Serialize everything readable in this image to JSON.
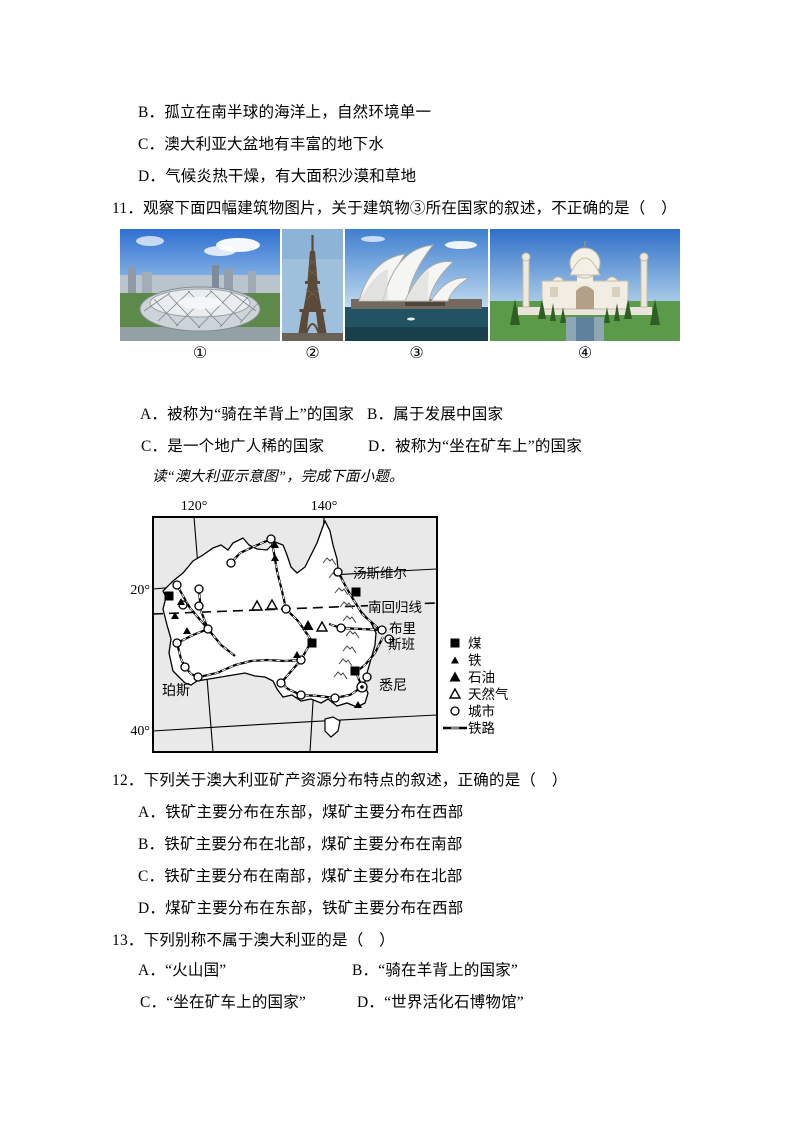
{
  "prev_question_options": [
    "B．孤立在南半球的海洋上，自然环境单一",
    "C．澳大利亚大盆地有丰富的地下水",
    "D．气候炎热干燥，有大面积沙漠和草地"
  ],
  "q11": {
    "stem": "11．观察下面四幅建筑物图片，关于建筑物③所在国家的叙述，不正确的是（　）",
    "image_labels": [
      "①",
      "②",
      "③",
      "④"
    ],
    "image_names": [
      "beijing-national-stadium",
      "eiffel-tower",
      "sydney-opera-house",
      "taj-mahal"
    ],
    "options": [
      "A．被称为“骑在羊背上”的国家",
      "B．属于发展中国家",
      "C．是一个地广人稀的国家",
      "D．被称为“坐在矿车上”的国家"
    ]
  },
  "reading_note": "读“澳大利亚示意图”，完成下面小题。",
  "map": {
    "title": "澳大利亚示意图",
    "lon_labels": [
      "120°",
      "140°"
    ],
    "lat_labels": [
      "20°",
      "40°"
    ],
    "tropic_label": "南回归线",
    "cities": {
      "townsville": "汤斯维尔",
      "brisbane_line1": "布里",
      "brisbane_line2": "斯班",
      "sydney": "悉尼",
      "perth": "珀斯"
    },
    "legend": [
      {
        "symbol": "coal-square",
        "label": "煤"
      },
      {
        "symbol": "iron-triangle-small",
        "label": "铁"
      },
      {
        "symbol": "oil-triangle-large",
        "label": "石油"
      },
      {
        "symbol": "gas-triangle-open",
        "label": "天然气"
      },
      {
        "symbol": "city-circle",
        "label": "城市"
      },
      {
        "symbol": "railway-line",
        "label": "铁路"
      }
    ],
    "colors": {
      "ocean": "#e9e9e9",
      "land": "#ffffff",
      "ink": "#000000"
    }
  },
  "q12": {
    "stem": "12．下列关于澳大利亚矿产资源分布特点的叙述，正确的是（　）",
    "options": [
      "A．铁矿主要分布在东部，煤矿主要分布在西部",
      "B．铁矿主要分布在北部，煤矿主要分布在南部",
      "C．铁矿主要分布在南部，煤矿主要分布在北部",
      "D．煤矿主要分布在东部，铁矿主要分布在西部"
    ]
  },
  "q13": {
    "stem": "13．下列别称不属于澳大利亚的是（　）",
    "options": [
      "A．“火山国”",
      "B．“骑在羊背上的国家”",
      "C．“坐在矿车上的国家”",
      "D．“世界活化石博物馆”"
    ]
  }
}
